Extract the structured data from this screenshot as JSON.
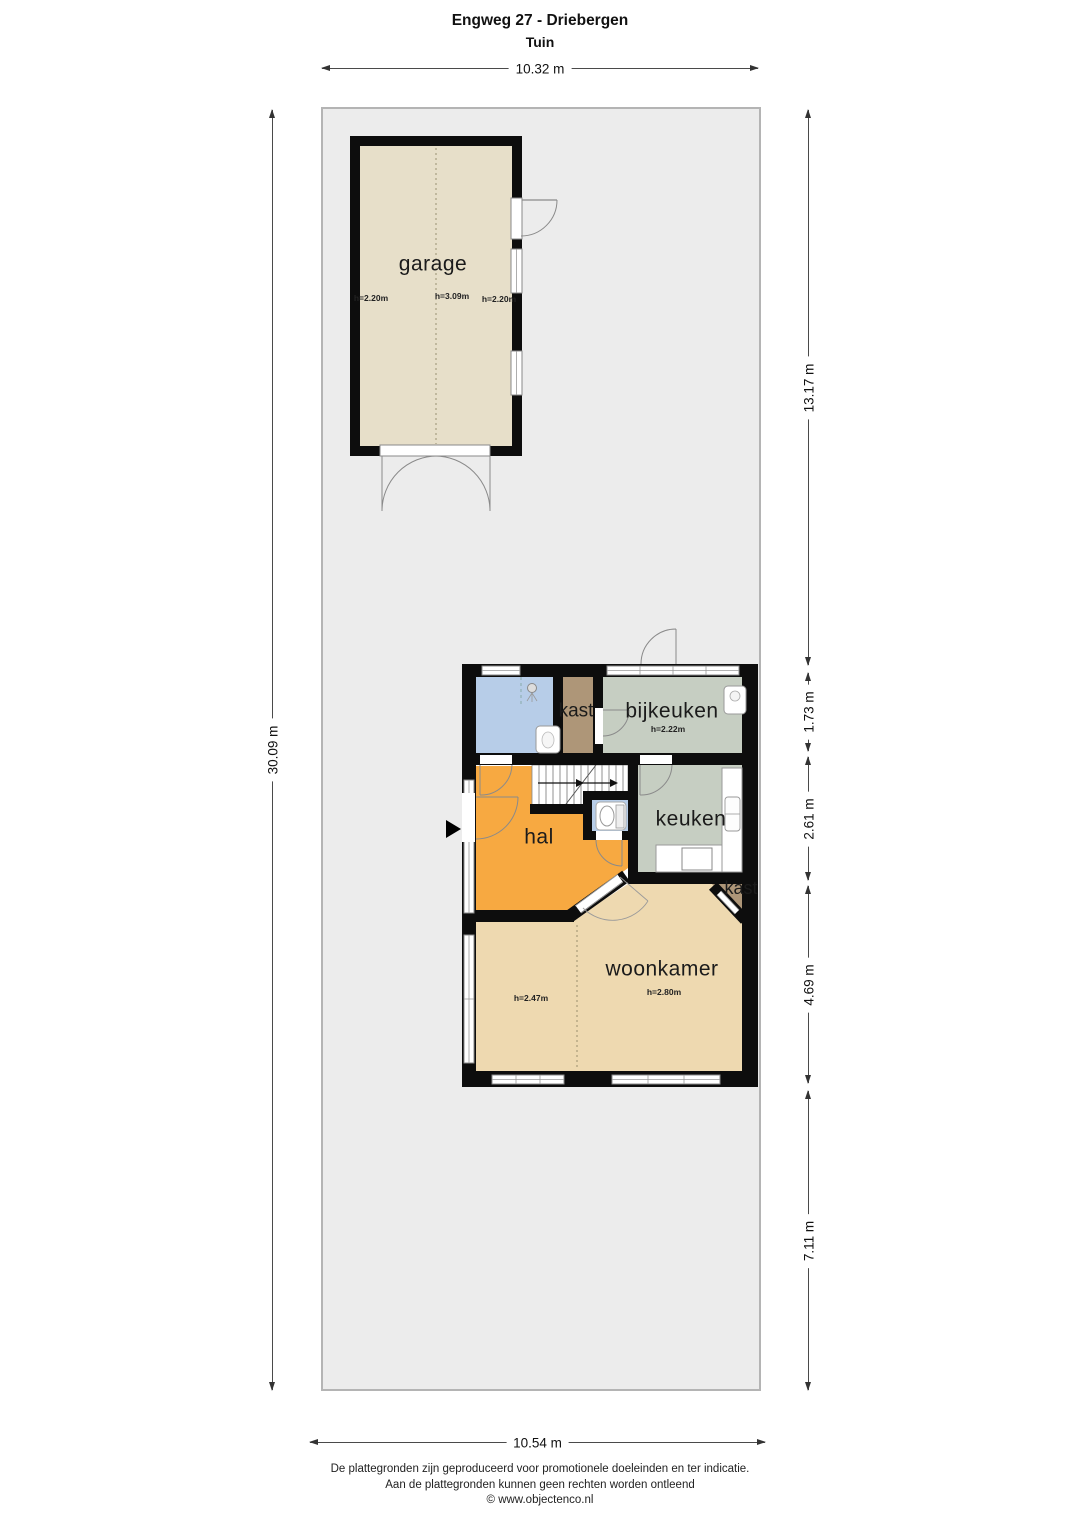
{
  "title": {
    "line1": "Engweg 27 - Driebergen",
    "line2": "Tuin"
  },
  "dimensions": {
    "top": "10.32 m",
    "left": "30.09 m",
    "bottom": "10.54 m",
    "right": [
      "13.17 m",
      "1.73 m",
      "2.61 m",
      "4.69 m",
      "7.11 m"
    ]
  },
  "rooms": {
    "garage": {
      "label": "garage",
      "heights": [
        "h=2.20m",
        "h=3.09m",
        "h=2.20m"
      ]
    },
    "kast1": {
      "label": "kast"
    },
    "bijkeuken": {
      "label": "bijkeuken",
      "height": "h=2.22m"
    },
    "hal": {
      "label": "hal"
    },
    "keuken": {
      "label": "keuken"
    },
    "kast2": {
      "label": "kast"
    },
    "woonkamer": {
      "label": "woonkamer",
      "height_left": "h=2.47m",
      "height_right": "h=2.80m"
    }
  },
  "footer": [
    "De plattegronden zijn geproduceerd voor promotionele doeleinden en ter indicatie.",
    "Aan de plattegronden kunnen geen rechten worden ontleend",
    "© www.objectenco.nl"
  ],
  "colors": {
    "garden": "#ececec",
    "garden_border": "#b4b4b4",
    "garage_floor": "#e7dfc9",
    "wet_room": "#b7cde8",
    "kast": "#ae9678",
    "bijkeuken": "#c6cec2",
    "keuken": "#c6cec2",
    "hal": "#f7a941",
    "woonkamer": "#eed9b0",
    "wall": "#0d0d0d"
  }
}
